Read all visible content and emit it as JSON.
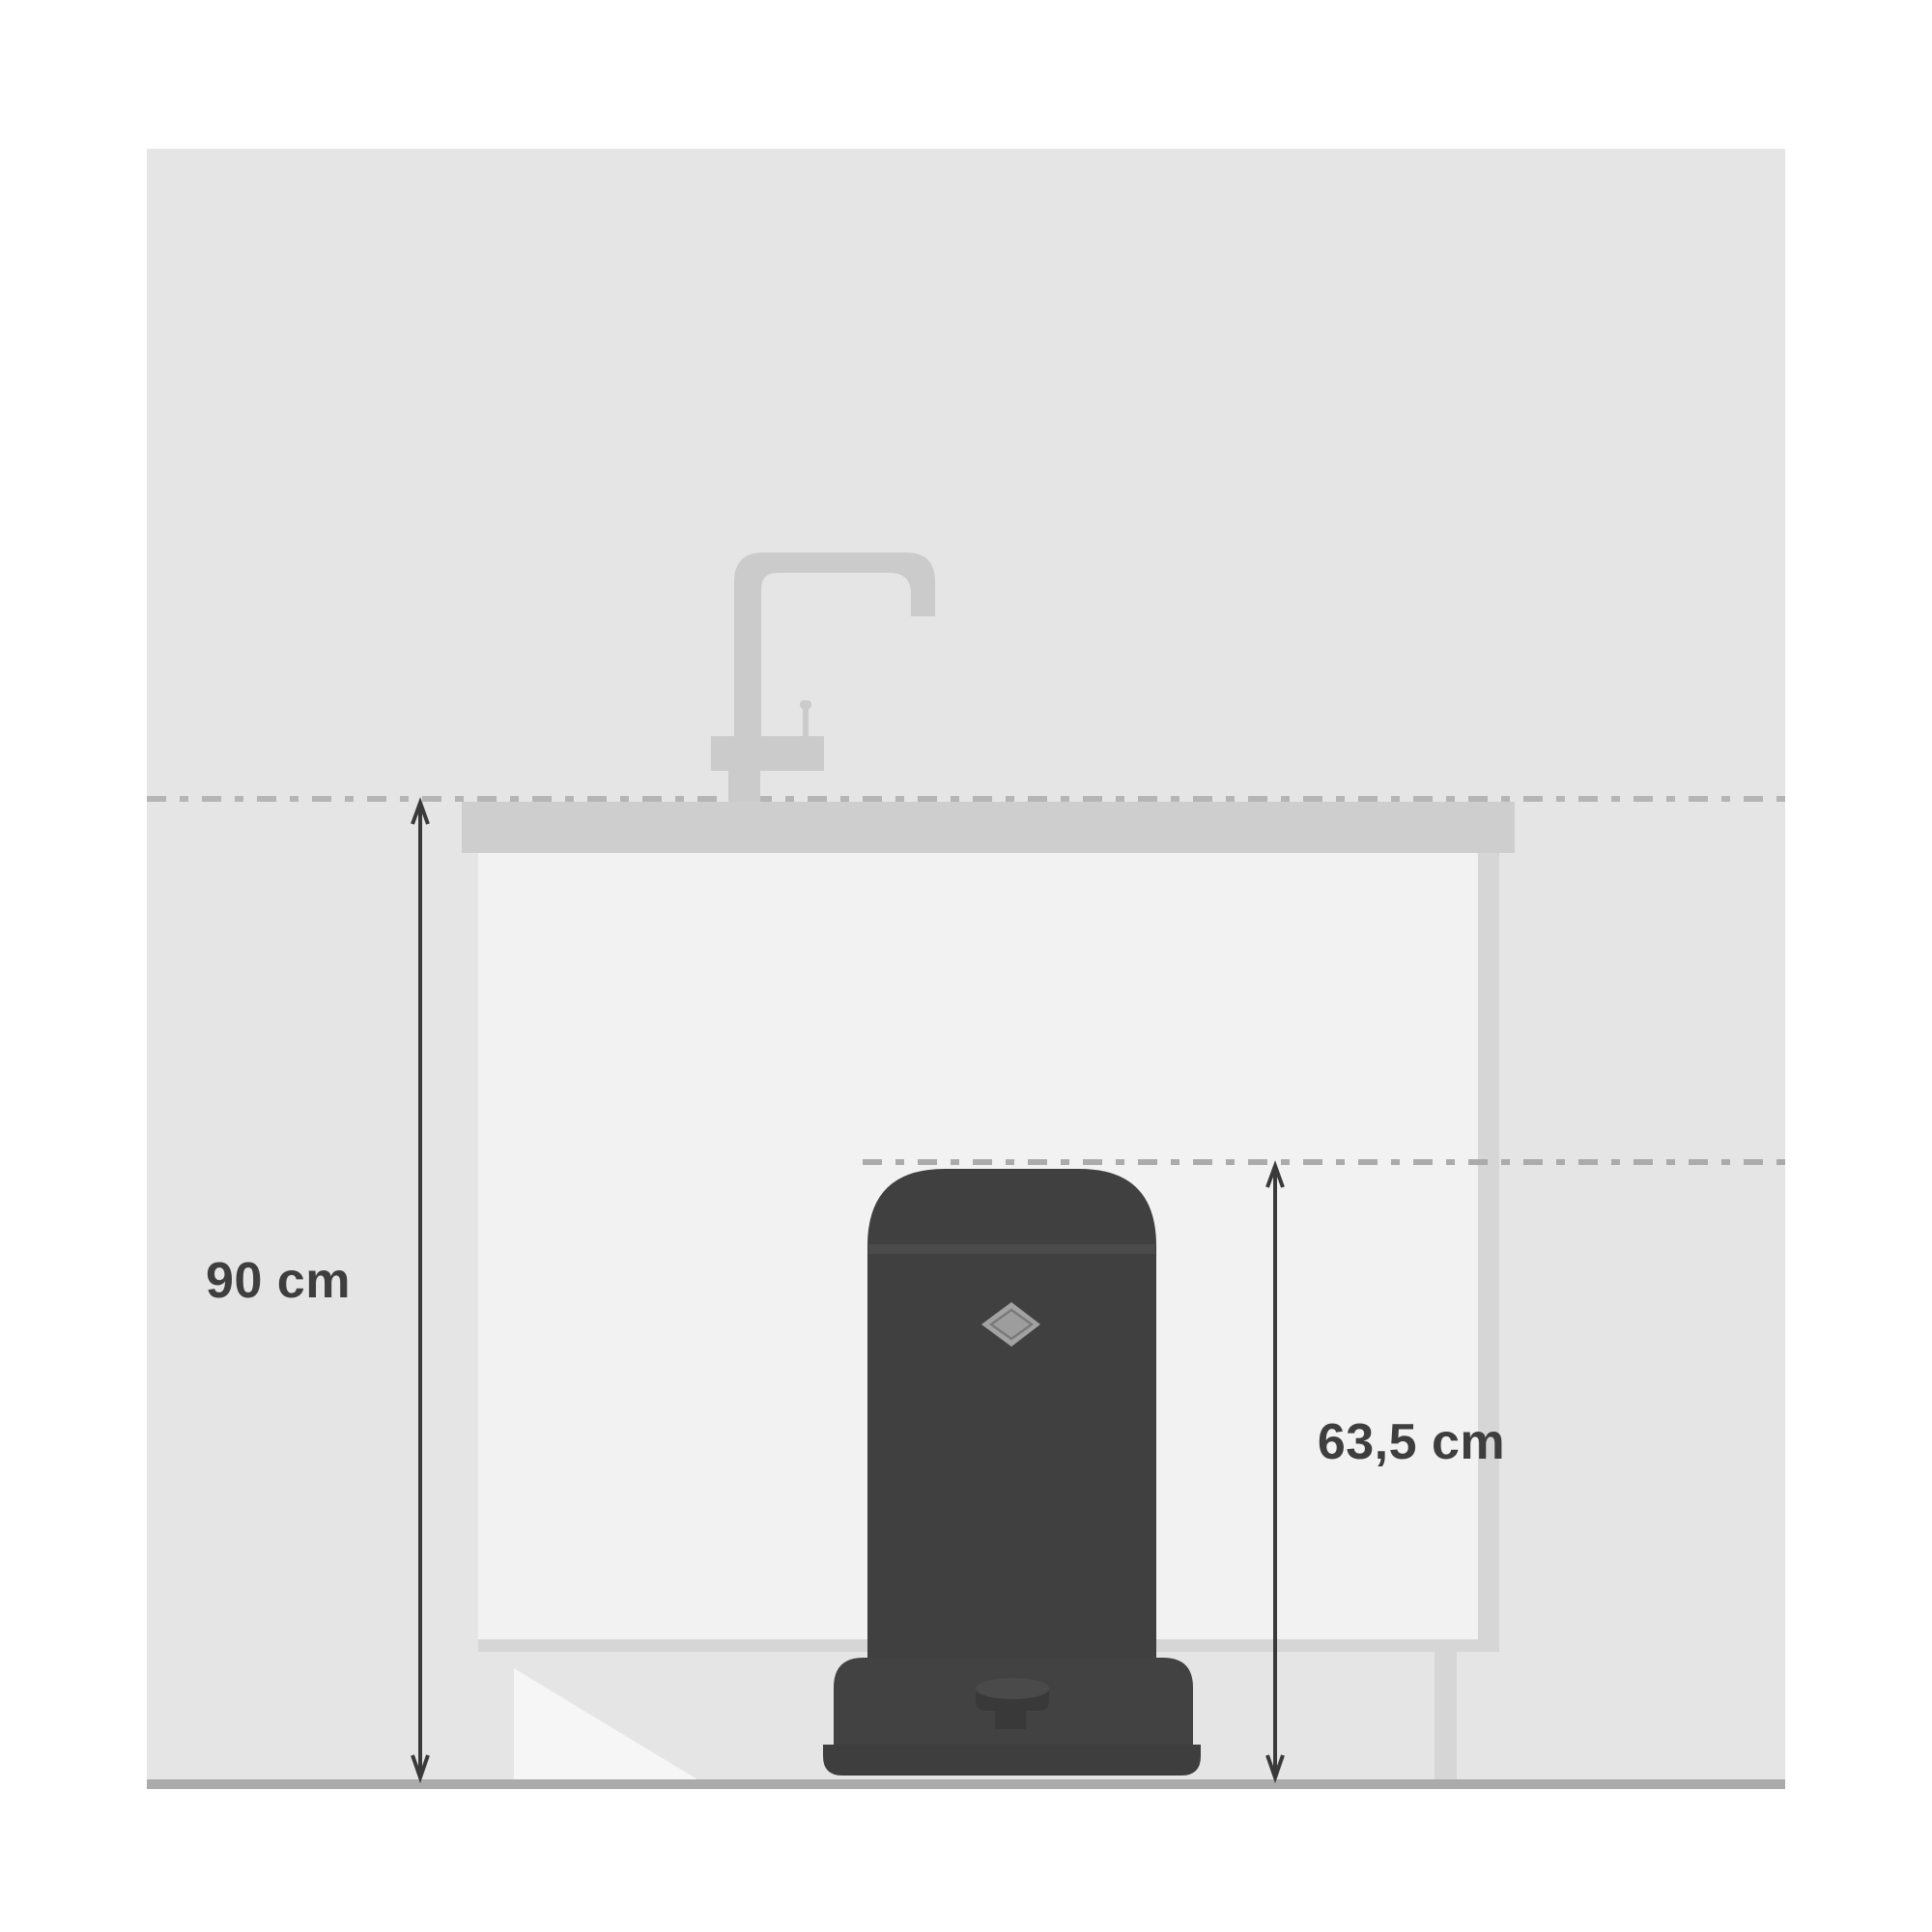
{
  "labels": {
    "counter_height": "90 cm",
    "bin_height": "63,5 cm"
  },
  "measurements": [
    {
      "name": "counter-height",
      "value": "90 cm"
    },
    {
      "name": "bin-height",
      "value": "63,5 cm"
    }
  ],
  "colors": {
    "page": "#ffffff",
    "wall": "#e5e5e5",
    "floor": "#ababab",
    "counter": "#cecece",
    "cabinet_panel": "#f2f2f3",
    "cabinet_trim": "#d6d6d6",
    "door_triangle": "#f6f6f6",
    "faucet": "#cbcbcb",
    "dash_line_1": "#b5b5b5",
    "dash_line_2": "#ababab",
    "bin_body": "#404040",
    "bin_lid_seam": "#4b4b4b",
    "bin_base": "#424242",
    "bin_foot": "#3e3e3e",
    "bin_pedal": "#393939",
    "bin_pedal_top": "#4a4a4a",
    "emblem_outer": "#a2a2a2",
    "emblem_inner": "#9d9d9d",
    "emblem_ring": "#7a7a7a",
    "arrow": "#3a3a3a",
    "label_text": "#3e3e3e"
  }
}
